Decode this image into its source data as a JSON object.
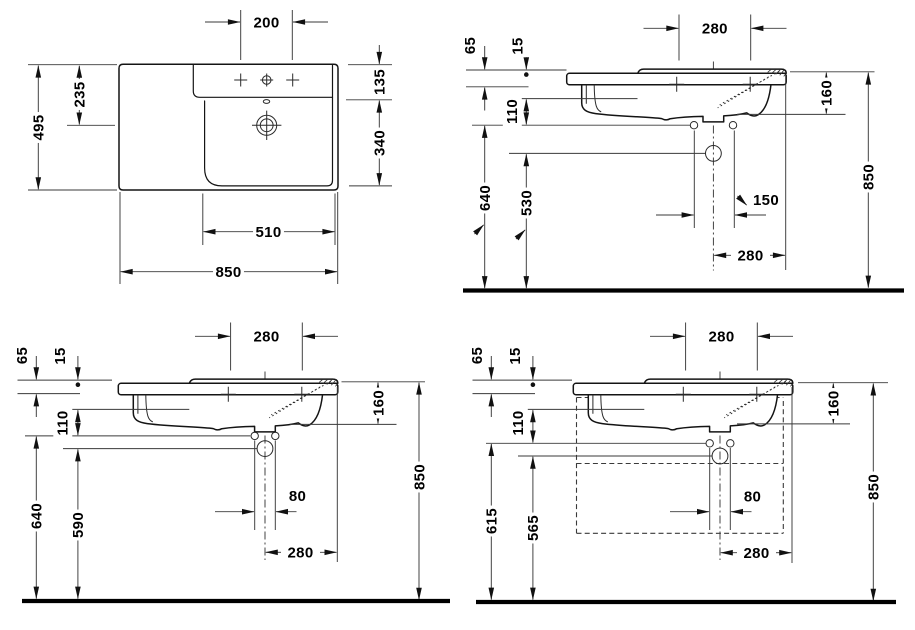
{
  "drawing": {
    "title": "Washbasin technical drawing with four dimensioned views",
    "unit": "mm",
    "line_color": "#141414",
    "views": {
      "plan": {
        "name": "plan view (top)",
        "dims": {
          "tap_hole_spacing": "200",
          "total_depth": "495",
          "front_edge_to_drain": "235",
          "deck_depth": "135",
          "bowl_depth": "340",
          "bowl_width": "510",
          "total_width": "850"
        }
      },
      "front_siphon": {
        "name": "front elevation with siphon / fixing heights",
        "dims": {
          "tap_centres": "280",
          "back_ledge_height": "65",
          "rim_step": "15",
          "rim_to_fixing": "110",
          "fixing_height": "640",
          "drain_height": "530",
          "rim_to_underside": "160",
          "fixing_centres": "150",
          "drain_to_edge": "280",
          "rim_height": "850"
        }
      },
      "front_fixing": {
        "name": "front elevation with fixing holes",
        "dims": {
          "tap_centres": "280",
          "back_ledge_height": "65",
          "rim_step": "15",
          "rim_to_fixing": "110",
          "fixing_height": "640",
          "drain_height": "590",
          "rim_to_underside": "160",
          "fixing_centres": "80",
          "drain_to_edge": "280",
          "rim_height": "850"
        }
      },
      "front_furniture": {
        "name": "front elevation with furniture outline",
        "dims": {
          "tap_centres": "280",
          "back_ledge_height": "65",
          "rim_step": "15",
          "rim_to_fixing": "110",
          "fixing_height": "615",
          "drain_height": "565",
          "rim_to_underside": "160",
          "fixing_centres": "80",
          "drain_to_edge": "280",
          "rim_height": "850"
        }
      }
    }
  }
}
